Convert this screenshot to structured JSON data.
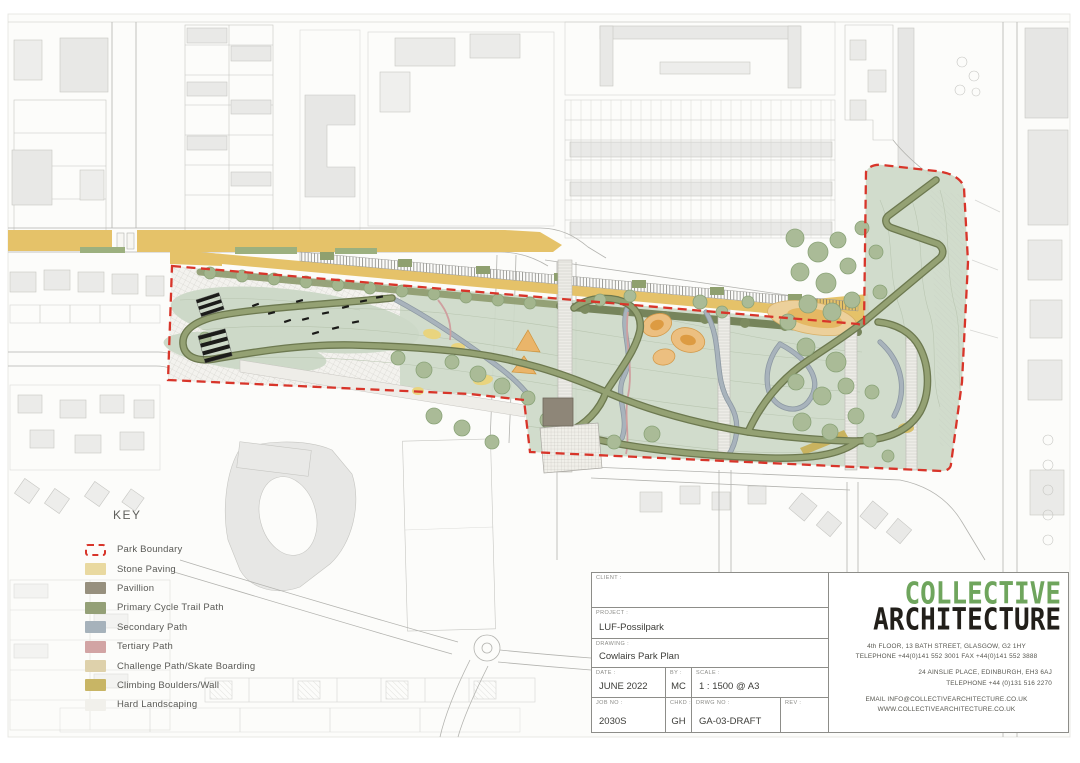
{
  "drawing": {
    "key": {
      "title": "KEY",
      "items": [
        {
          "label": "Park Boundary",
          "color": "#d8352a",
          "swatch": "boundary"
        },
        {
          "label": "Stone Paving",
          "color": "#e9d9a0"
        },
        {
          "label": "Pavillion",
          "color": "#97907e"
        },
        {
          "label": "Primary Cycle Trail Path",
          "color": "#94a077"
        },
        {
          "label": "Secondary Path",
          "color": "#a6b2bb"
        },
        {
          "label": "Tertiary Path",
          "color": "#d2a4a4"
        },
        {
          "label": "Challenge Path/Skate Boarding",
          "color": "#ded1ab"
        },
        {
          "label": "Climbing Boulders/Wall",
          "color": "#c8b565"
        },
        {
          "label": "Hard Landscaping",
          "color": "#f1f0eb"
        }
      ]
    },
    "title_block": {
      "client_label": "CLIENT :",
      "client_value": "",
      "project_label": "PROJECT :",
      "project_value": "LUF-Possilpark",
      "drawing_label": "DRAWING :",
      "drawing_value": "Cowlairs Park Plan",
      "date_label": "DATE :",
      "date_value": "JUNE 2022",
      "by_label": "BY :",
      "by_value": "MC",
      "scale_label": "SCALE :",
      "scale_value": "1 : 1500 @ A3",
      "job_no_label": "JOB NO :",
      "job_no_value": "2030S",
      "chkd_label": "CHKD :",
      "chkd_value": "GH",
      "drwg_no_label": "DRWG NO :",
      "drwg_no_value": "GA-03-DRAFT",
      "rev_label": "REV :",
      "rev_value": ""
    },
    "firm": {
      "name_line1": "COLLECTIVE",
      "name_line2": "ARCHITECTURE",
      "brand_green": "#6fa55d",
      "brand_black": "#221f1a",
      "address1": "4th FLOOR, 13 BATH STREET,  GLASGOW, G2 1HY",
      "phone1": "TELEPHONE +44(0)141 552 3001 FAX +44(0)141 552 3888",
      "address2": "24 AINSLIE PLACE, EDINBURGH, EH3 6AJ",
      "phone2": "TELEPHONE +44 (0)131 516 2270",
      "email": "EMAIL INFO@COLLECTIVEARCHITECTURE.CO.UK",
      "web": "WWW.COLLECTIVEARCHITECTURE.CO.UK"
    }
  }
}
